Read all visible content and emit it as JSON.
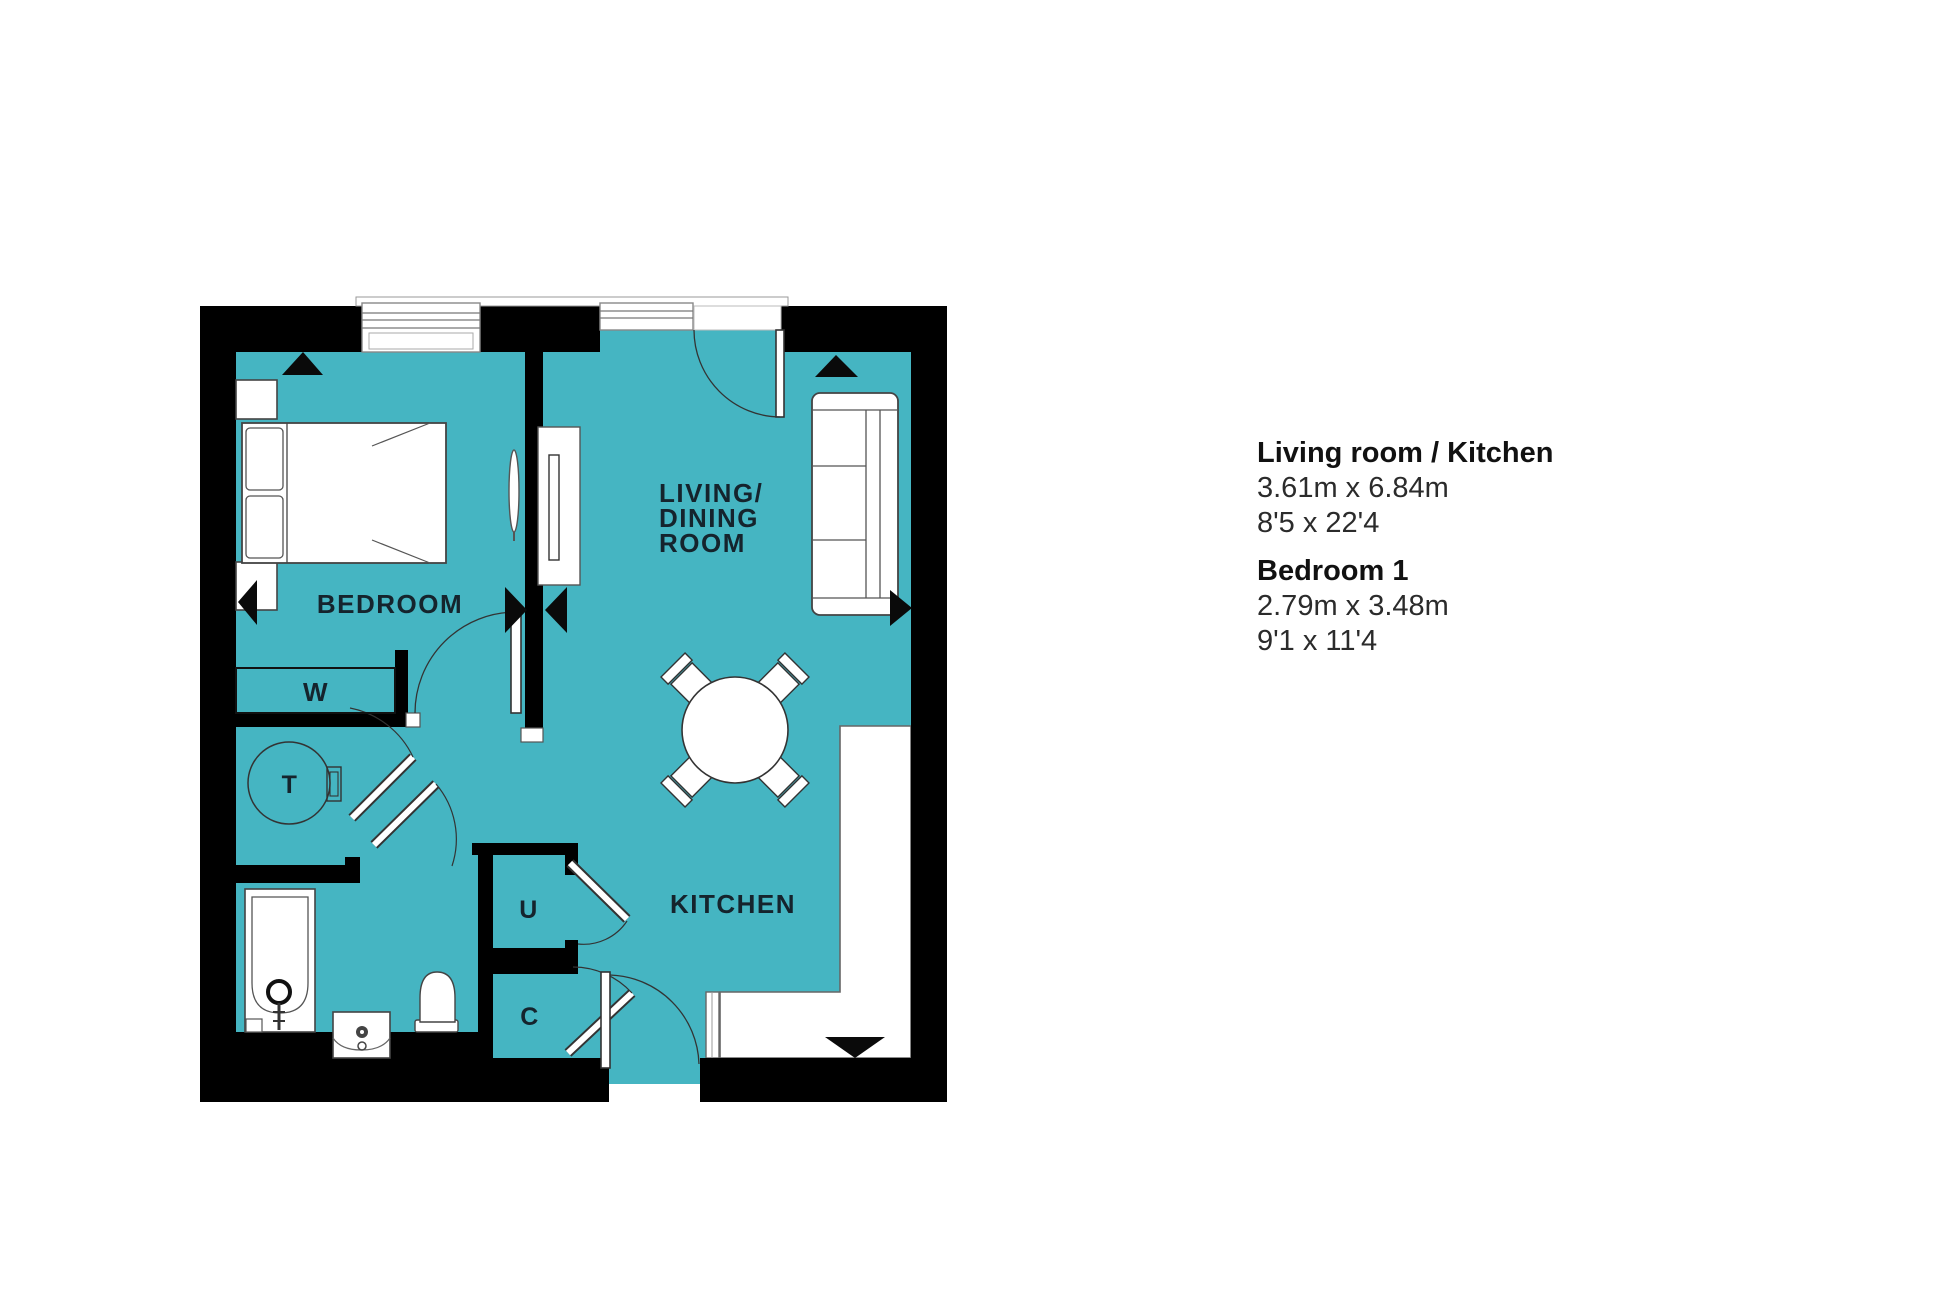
{
  "colors": {
    "floor": "#45b5c2",
    "wall": "#000000",
    "furniture_outline": "#3c3c3c",
    "label_text": "#15242d"
  },
  "floor_plan": {
    "labels": {
      "bedroom": "BEDROOM",
      "living_lines": [
        "LIVING/",
        "DINING",
        "ROOM"
      ],
      "kitchen": "KITCHEN",
      "wardrobe": "W",
      "table": "T",
      "utility": "U",
      "cupboard": "C"
    }
  },
  "room_details": [
    {
      "title": "Living room / Kitchen",
      "metric": "3.61m x 6.84m",
      "imperial": "8'5 x 22'4"
    },
    {
      "title": "Bedroom 1",
      "metric": "2.79m x 3.48m",
      "imperial": "9'1 x 11'4"
    }
  ]
}
